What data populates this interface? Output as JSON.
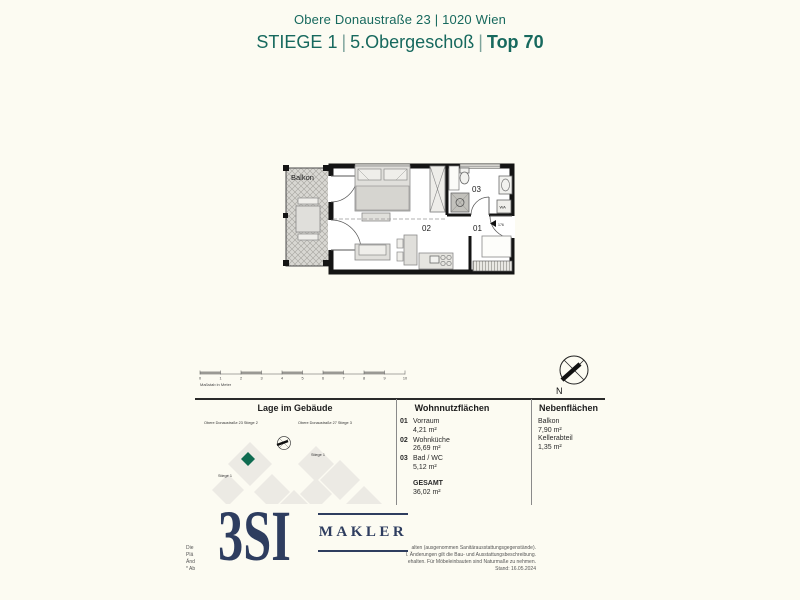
{
  "header": {
    "address": "Obere Donaustraße 23 | 1020 Wien",
    "stiege": "STIEGE 1",
    "sep": "|",
    "floor": "5.Obergeschoß",
    "top": "Top 70"
  },
  "floorplan": {
    "balkon_label": "Balkon",
    "labels": {
      "vorraum": "01",
      "wohnkueche": "02",
      "bad": "03"
    },
    "wa_label": "WA",
    "door_dim": "176"
  },
  "scalebar": {
    "label": "Maßstab in Meter",
    "ticks": [
      "0",
      "1",
      "2",
      "3",
      "4",
      "5",
      "6",
      "7",
      "8",
      "9",
      "10"
    ]
  },
  "compass": {
    "north_label": "N"
  },
  "sections": {
    "lage": {
      "title": "Lage im Gebäude",
      "labels": [
        "Obere Donaustraße 23 Stiege 2",
        "Obere Donaustraße 27 Stiege 3",
        "Stiege 1",
        "Stiege 1"
      ]
    },
    "wohnnutzflaechen": {
      "title": "Wohnnutzflächen",
      "rooms": [
        {
          "num": "01",
          "name": "Vorraum",
          "area": "4,21 m²"
        },
        {
          "num": "02",
          "name": "Wohnküche",
          "area": "26,69 m²"
        },
        {
          "num": "03",
          "name": "Bad / WC",
          "area": "5,12 m²"
        }
      ],
      "total_label": "GESAMT",
      "total_area": "36,02 m²"
    },
    "nebenflaechen": {
      "title": "Nebenflächen",
      "items": [
        {
          "name": "Balkon",
          "area": "7,90 m²"
        },
        {
          "name": "Kellerabteil",
          "area": "1,35 m²"
        }
      ]
    }
  },
  "footer": {
    "logo_text": "3SI",
    "logo_sub": "MAKLER",
    "left_fragments": [
      "Die",
      "Plä",
      "Änd",
      "* Ab"
    ],
    "disclaimer_lines": [
      "alten (ausgenommen Sanitärausstattungsgegenstände).",
      "l. Änderungen gilt die Bau- und Ausstattungsbeschreibung.",
      "ehalten. Für Möbeleinbauten sind Naturmaße zu nehmen.",
      "Stand: 16.05.2024"
    ]
  },
  "colors": {
    "teal": "#17695e",
    "navy": "#2e3d5f",
    "unit_green": "#0e6b50"
  }
}
